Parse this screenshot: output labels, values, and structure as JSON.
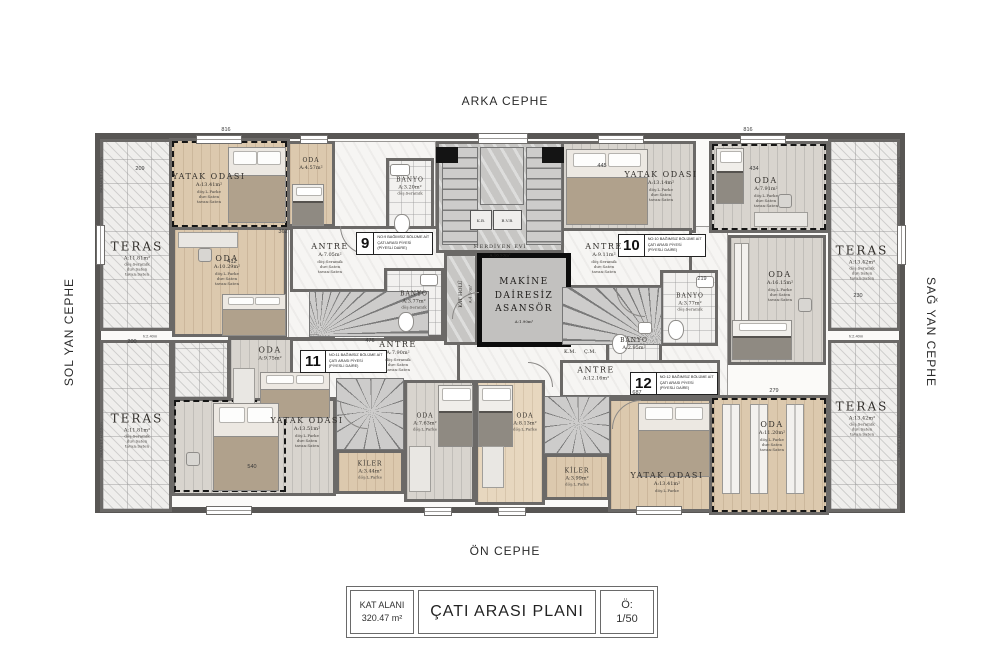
{
  "facades": {
    "top": "ARKA CEPHE",
    "bottom": "ÖN CEPHE",
    "left": "SOL YAN CEPHE",
    "right": "SAĞ YAN CEPHE"
  },
  "title_block": {
    "area_label": "KAT ALANI",
    "area_value": "320.47 m²",
    "plan_title": "ÇATI ARASI PLANI",
    "scale_label": "Ö:",
    "scale_value": "1/50"
  },
  "core": {
    "elevator_line1": "MAKİNE",
    "elevator_line2": "DAİRESİZ",
    "elevator_line3": "ASANSÖR",
    "elevator_area": "A:1.90m²",
    "stairwell_name": "MERDİVEN EVİ",
    "stairwell_area": "A:16.93m²",
    "hall_name": "KAT HOLÜ",
    "hall_area": "A:4.10m²",
    "km": "K.M.",
    "cm": "Ç.M.",
    "kb": "K.B.",
    "bvb": "B.V.B."
  },
  "units": [
    {
      "no": "9",
      "line1": "NO:9 BAĞIMSIZ BÖLÜME AİT",
      "line2": "ÇATI ARASI PİYESİ",
      "line3": "(PİYESLİ DAİRE)"
    },
    {
      "no": "10",
      "line1": "NO:10 BAĞIMSIZ BÖLÜME AİT",
      "line2": "ÇATI ARASI PİYESİ",
      "line3": "(PİYESLİ DAİRE)"
    },
    {
      "no": "11",
      "line1": "NO:11 BAĞIMSIZ BÖLÜME AİT",
      "line2": "ÇATI ARASI PİYESİ",
      "line3": "(PİYESLİ DAİRE)"
    },
    {
      "no": "12",
      "line1": "NO:12 BAĞIMSIZ BÖLÜME AİT",
      "line2": "ÇATI ARASI PİYESİ",
      "line3": "(PİYESLİ DAİRE)"
    }
  ],
  "rooms": [
    {
      "name": "TERAS",
      "area": "A:11.81m²",
      "f1": "döş:Seramik",
      "f2": "duv:Saten",
      "f3": "tavan:Saten"
    },
    {
      "name": "TERAS",
      "area": "A:11.81m²",
      "f1": "döş:Seramik",
      "f2": "duv:Saten",
      "f3": "tavan:Saten"
    },
    {
      "name": "TERAS",
      "area": "A:13.42m²",
      "f1": "döş:Seramik",
      "f2": "duv:Saten",
      "f3": "tavan:Saten"
    },
    {
      "name": "TERAS",
      "area": "A:13.42m²",
      "f1": "döş:Seramik",
      "f2": "duv:Saten",
      "f3": "tavan:Saten"
    },
    {
      "name": "YATAK ODASI",
      "area": "A:13.41m²",
      "f1": "döş:L.Parke",
      "f2": "duv:Saten",
      "f3": "tavan:Saten"
    },
    {
      "name": "ODA",
      "area": "A:4.57m²",
      "f1": "döş:L.Parke",
      "f2": "duv:Saten",
      "f3": "tavan:Saten"
    },
    {
      "name": "BANYO",
      "area": "A:3.20m²",
      "f1": "döş:Seramik",
      "f2": "duv:Seramik",
      "f3": "tavan:Saten"
    },
    {
      "name": "ANTRE",
      "area": "A:7.05m²",
      "f1": "döş:Seramik",
      "f2": "duv:Saten",
      "f3": "tavan:Saten"
    },
    {
      "name": "ODA",
      "area": "A:10.29m²",
      "f1": "döş:L.Parke",
      "f2": "duv:Saten",
      "f3": "tavan:Saten"
    },
    {
      "name": "BANYO",
      "area": "A:3.77m²",
      "f1": "döş:Seramik",
      "f2": "duv:Seramik",
      "f3": "tavan:Saten"
    },
    {
      "name": "ANTRE",
      "area": "A:9.11m²",
      "f1": "döş:Seramik",
      "f2": "duv:Saten",
      "f3": "tavan:Saten"
    },
    {
      "name": "YATAK ODASI",
      "area": "A:13.14m²",
      "f1": "döş:L.Parke",
      "f2": "duv:Saten",
      "f3": "tavan:Saten"
    },
    {
      "name": "ODA",
      "area": "A:7.91m²",
      "f1": "döş:L.Parke",
      "f2": "duv:Saten",
      "f3": "tavan:Saten"
    },
    {
      "name": "ODA",
      "area": "A:16.15m²",
      "f1": "döş:L.Parke",
      "f2": "duv:Saten",
      "f3": "tavan:Saten"
    },
    {
      "name": "BANYO",
      "area": "A:3.77m²",
      "f1": "döş:Seramik",
      "f2": "duv:Seramik",
      "f3": "tavan:Saten"
    },
    {
      "name": "BANYO",
      "area": "A:2.95m²",
      "f1": "döş:Seramik",
      "f2": "duv:Seramik",
      "f3": "tavan:Saten"
    },
    {
      "name": "ANTRE",
      "area": "A:7.90m²",
      "f1": "döş:Seramik",
      "f2": "duv:Saten",
      "f3": "tavan:Saten"
    },
    {
      "name": "ODA",
      "area": "A:9.75m²",
      "f1": "döş:L.Parke",
      "f2": "duv:Saten",
      "f3": "tavan:Saten"
    },
    {
      "name": "YATAK ODASI",
      "area": "A:13.51m²",
      "f1": "döş:L.Parke",
      "f2": "duv:Saten",
      "f3": "tavan:Saten"
    },
    {
      "name": "KİLER",
      "area": "A:3.44m²",
      "f1": "döş:L.Parke",
      "f2": "duv:Saten",
      "f3": "tavan:Saten"
    },
    {
      "name": "ODA",
      "area": "A:7.63m²",
      "f1": "döş:L.Parke",
      "f2": "duv:Saten",
      "f3": "tavan:Saten"
    },
    {
      "name": "ODA",
      "area": "A:8.13m²",
      "f1": "döş:L.Parke",
      "f2": "duv:Saten",
      "f3": "tavan:Saten"
    },
    {
      "name": "KİLER",
      "area": "A:3.99m²",
      "f1": "döş:L.Parke",
      "f2": "duv:Saten",
      "f3": "tavan:Saten"
    },
    {
      "name": "ANTRE",
      "area": "A:12.16m²",
      "f1": "döş:Seramik",
      "f2": "duv:Saten",
      "f3": "tavan:Saten"
    },
    {
      "name": "YATAK ODASI",
      "area": "A:13.41m²",
      "f1": "döş:L.Parke",
      "f2": "duv:Saten",
      "f3": "tavan:Saten"
    },
    {
      "name": "ODA",
      "area": "A:11.20m²",
      "f1": "döş:L.Parke",
      "f2": "duv:Saten",
      "f3": "tavan:Saten"
    }
  ],
  "dims": [
    "816",
    "816",
    "209",
    "445",
    "434",
    "412",
    "362",
    "476",
    "687",
    "540",
    "219",
    "230",
    "200",
    "279"
  ],
  "notes": {
    "parapet": "PARAPET H:110cm",
    "headroom": "h:2.40m"
  }
}
